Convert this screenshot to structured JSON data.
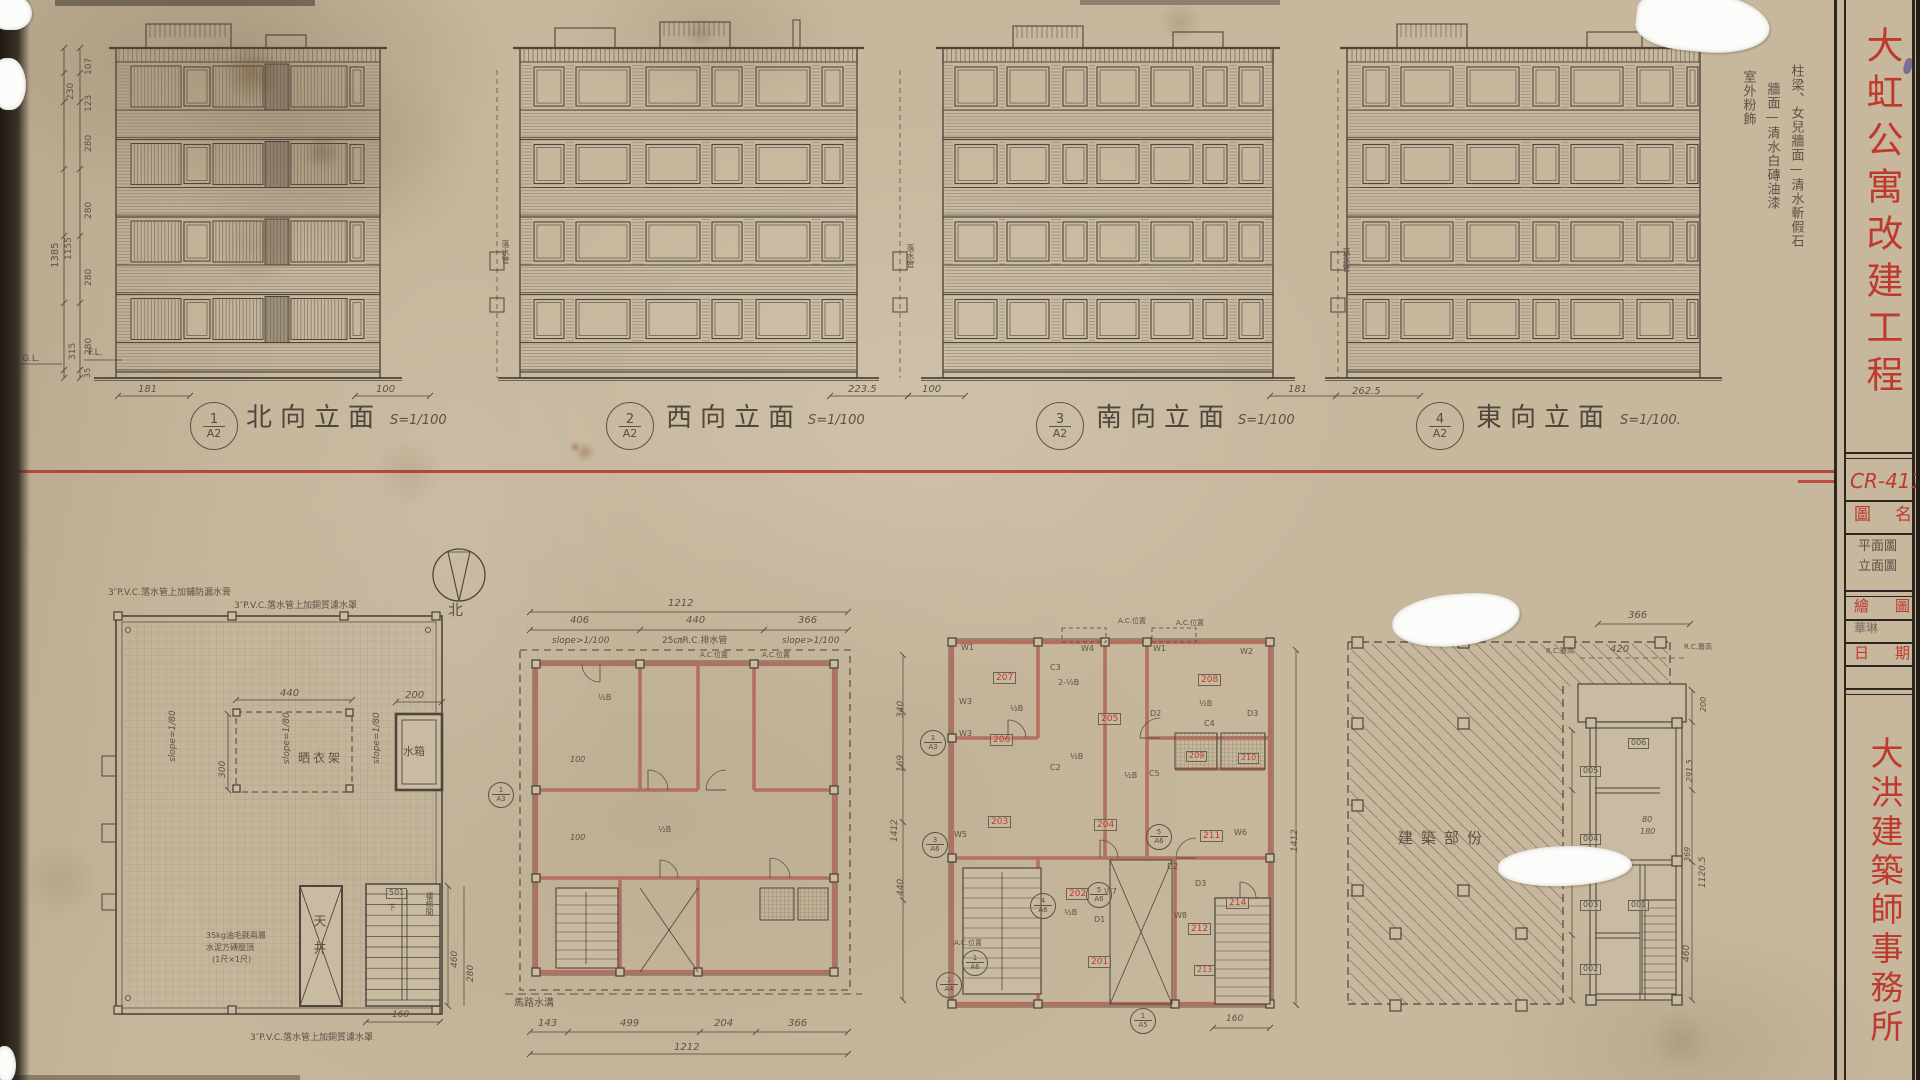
{
  "title_block": {
    "project": "大虹公寓改建工程",
    "drawing_no": "CR-411",
    "name_label": "圖名",
    "name_value_1": "平面圖",
    "name_value_2": "立面圖",
    "drafter_label": "繪圖",
    "drafter_value": "華琳",
    "date_label": "日期",
    "firm": "大洪建築師事務所"
  },
  "finish_notes": {
    "line1": "柱梁、女兒牆面—清水斬假石",
    "line2": "牆面—清水白磚油漆",
    "line3": "室外粉飾"
  },
  "elevations": [
    {
      "num": "1",
      "sheet": "A2",
      "name": "北向立面",
      "scale": "S=1/100"
    },
    {
      "num": "2",
      "sheet": "A2",
      "name": "西向立面",
      "scale": "S=1/100"
    },
    {
      "num": "3",
      "sheet": "A2",
      "name": "南向立面",
      "scale": "S=1/100"
    },
    {
      "num": "4",
      "sheet": "A2",
      "name": "東向立面",
      "scale": "S=1/100."
    }
  ],
  "left_dims": {
    "d107": "107",
    "d123": "123",
    "d230": "230",
    "d280": "280",
    "d1385": "1385",
    "d1155": "1155",
    "d315": "315",
    "d35": "35",
    "gl": "G.L.",
    "fl": "F.L."
  },
  "base_dims": {
    "d181": "181",
    "d100": "100",
    "d2235": "223.5",
    "d2625": "262.5"
  },
  "pipe": "落水管",
  "compass_north": "北",
  "roof_plan": {
    "note_top": "3″P.V.C.落水管上加銅質濾水罩",
    "note_top_left": "3″P.V.C.落水管上加鋪防漏水膏",
    "note_bottom": "3″P.V.C.落水管上加銅質濾水罩",
    "slope": "slope=1/80",
    "drying_rack": "晒衣架",
    "water_tank": "水箱",
    "light_well": "天井",
    "stair_no": "501",
    "stair": "樓梯間",
    "down": "下",
    "coping_note_1": "35kg油毛氈兩層",
    "coping_note_2": "水泥方磚壓頂",
    "coping_note_3": "(1尺×1尺)",
    "d440": "440",
    "d200": "200",
    "d300": "300",
    "d460": "460",
    "d280": "280",
    "d160": "160"
  },
  "plan_b": {
    "d1212": "1212",
    "d406": "406",
    "d440": "440",
    "d366": "366",
    "slope": "slope>1/100",
    "drain": "25㎝R.C.排水管",
    "ac": "A.C.位置",
    "d143": "143",
    "d499": "499",
    "d204": "204",
    "gutter": "馬路水溝",
    "half_b": "½B",
    "d100": "100",
    "d340": "340",
    "d169": "169",
    "d1412": "1412",
    "d440r": "440"
  },
  "plan_c": {
    "rooms": [
      "201",
      "202",
      "203",
      "204",
      "205",
      "206",
      "207",
      "208",
      "209",
      "210",
      "211",
      "212",
      "213",
      "214"
    ],
    "w": [
      "W1",
      "W2",
      "W3",
      "W4",
      "W5",
      "W6",
      "W7",
      "W8"
    ],
    "d": [
      "D1",
      "D2",
      "D3"
    ],
    "c": [
      "C2",
      "C3",
      "C4",
      "C5"
    ],
    "half_b": "½B",
    "two_half_b": "2-½B",
    "ac": "A.C.位置",
    "sec": {
      "a3": "A3",
      "a4": "A4",
      "a5": "A5",
      "a6": "A6",
      "n1": "1",
      "n3": "3",
      "n4": "4",
      "n5": "5"
    },
    "d160": "160",
    "d1412": "1412"
  },
  "plan_d": {
    "label": "建築部份",
    "rooms": [
      "001",
      "002",
      "003",
      "004",
      "005",
      "006"
    ],
    "rc": "R.C.簷高",
    "d366": "366",
    "d420": "420",
    "d200": "200",
    "d2915": "291.5",
    "d80": "80",
    "d180": "180",
    "d369": "369",
    "d1120": "1120.5",
    "d460": "460"
  }
}
